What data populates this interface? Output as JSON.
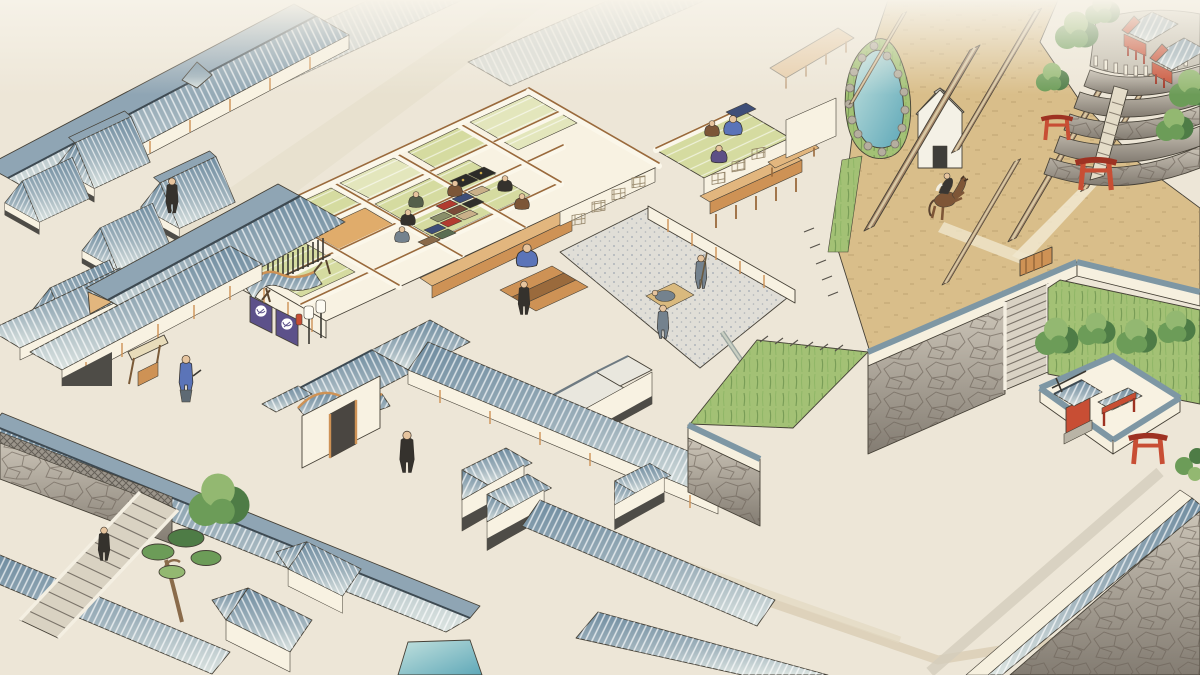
{
  "scene": {
    "description": "Bird's-eye woodblock-style illustration of an Edo-period magistrate compound: cutaway office with tatami rooms and white-gravel courtyard, noren entrance gate, townhouse rows, stone-walled riding ground with galloping horseman, pond, hilltop shrine with torii, walled corner shrine, and stone stairways",
    "style": "ukiyo-e watercolor, isometric bird's-eye view",
    "regions": [
      {
        "name": "townhouses-northwest",
        "kind": "tiled-roof row houses"
      },
      {
        "name": "magistrate-office-cutaway",
        "rooms": "tatami and wood floors",
        "courtyard": "white gravel",
        "figures_inside": 10
      },
      {
        "name": "entrance-gate",
        "noren_crests": 2,
        "lanterns": 2,
        "spear_rack": 1
      },
      {
        "name": "west-residence",
        "notice_board": 1
      },
      {
        "name": "riding-ground",
        "barriers": 6,
        "horseman": 1,
        "storehouse": 1,
        "pond": 1
      },
      {
        "name": "hilltop-shrine",
        "torii": 2,
        "shrine_buildings": 2,
        "terraces": 5
      },
      {
        "name": "walled-corner-shrine",
        "torii": 1
      },
      {
        "name": "southwest-stairway",
        "trees": [
          "pine",
          "broadleaf"
        ],
        "climbing_figure": 1
      },
      {
        "name": "street-figures",
        "count": 4
      }
    ]
  },
  "colors": {
    "paper": "#EDE6D7",
    "mist": "#F6F2E8",
    "ink": "#454036",
    "roof_deep": "#6F8CA0",
    "roof_mid": "#8FA5B4",
    "roof_pale": "#CBD7D6",
    "ridge": "#3E4A52",
    "wood": "#CE9255",
    "wood_dark": "#9A6A3C",
    "wood_light": "#E2B67E",
    "wall_cream": "#F8F2E2",
    "wall_shadow": "#EDE2CC",
    "wainscot": "#4E4C47",
    "tatami": "#D5DBA0",
    "tatami_pale": "#E3E6BC",
    "wood_floor": "#E0AC6B",
    "gravel": "#E0DED7",
    "gravel_dot": "#8E99A7",
    "field": "#D9BE8A",
    "field_speckle": "#A8895B",
    "path_light": "#EFE6CC",
    "grass": "#A3C175",
    "grass_dark": "#55803E",
    "grass_light": "#BCD48A",
    "tree_dark": "#4E7C46",
    "tree_mid": "#6C9C58",
    "tree_light": "#93B871",
    "stone_light": "#CCC5B8",
    "stone_dark": "#837C72",
    "stone_line": "#6B6156",
    "parapet": "#F6F0DF",
    "coping": "#7E97A4",
    "water_deep": "#5FA8B8",
    "water_light": "#C2E1DE",
    "vermilion": "#C84E34",
    "vermilion_dark": "#9E3222",
    "noren": "#5C518A",
    "robe_blue": "#5B74B8",
    "robe_gray": "#74828E",
    "robe_black": "#35322D",
    "robe_brown": "#7C5638",
    "robe_green": "#55604A",
    "robe_purple": "#5D5086",
    "skin": "#E6C49E",
    "horse": "#7E5637",
    "mat": "#D9B97E"
  }
}
